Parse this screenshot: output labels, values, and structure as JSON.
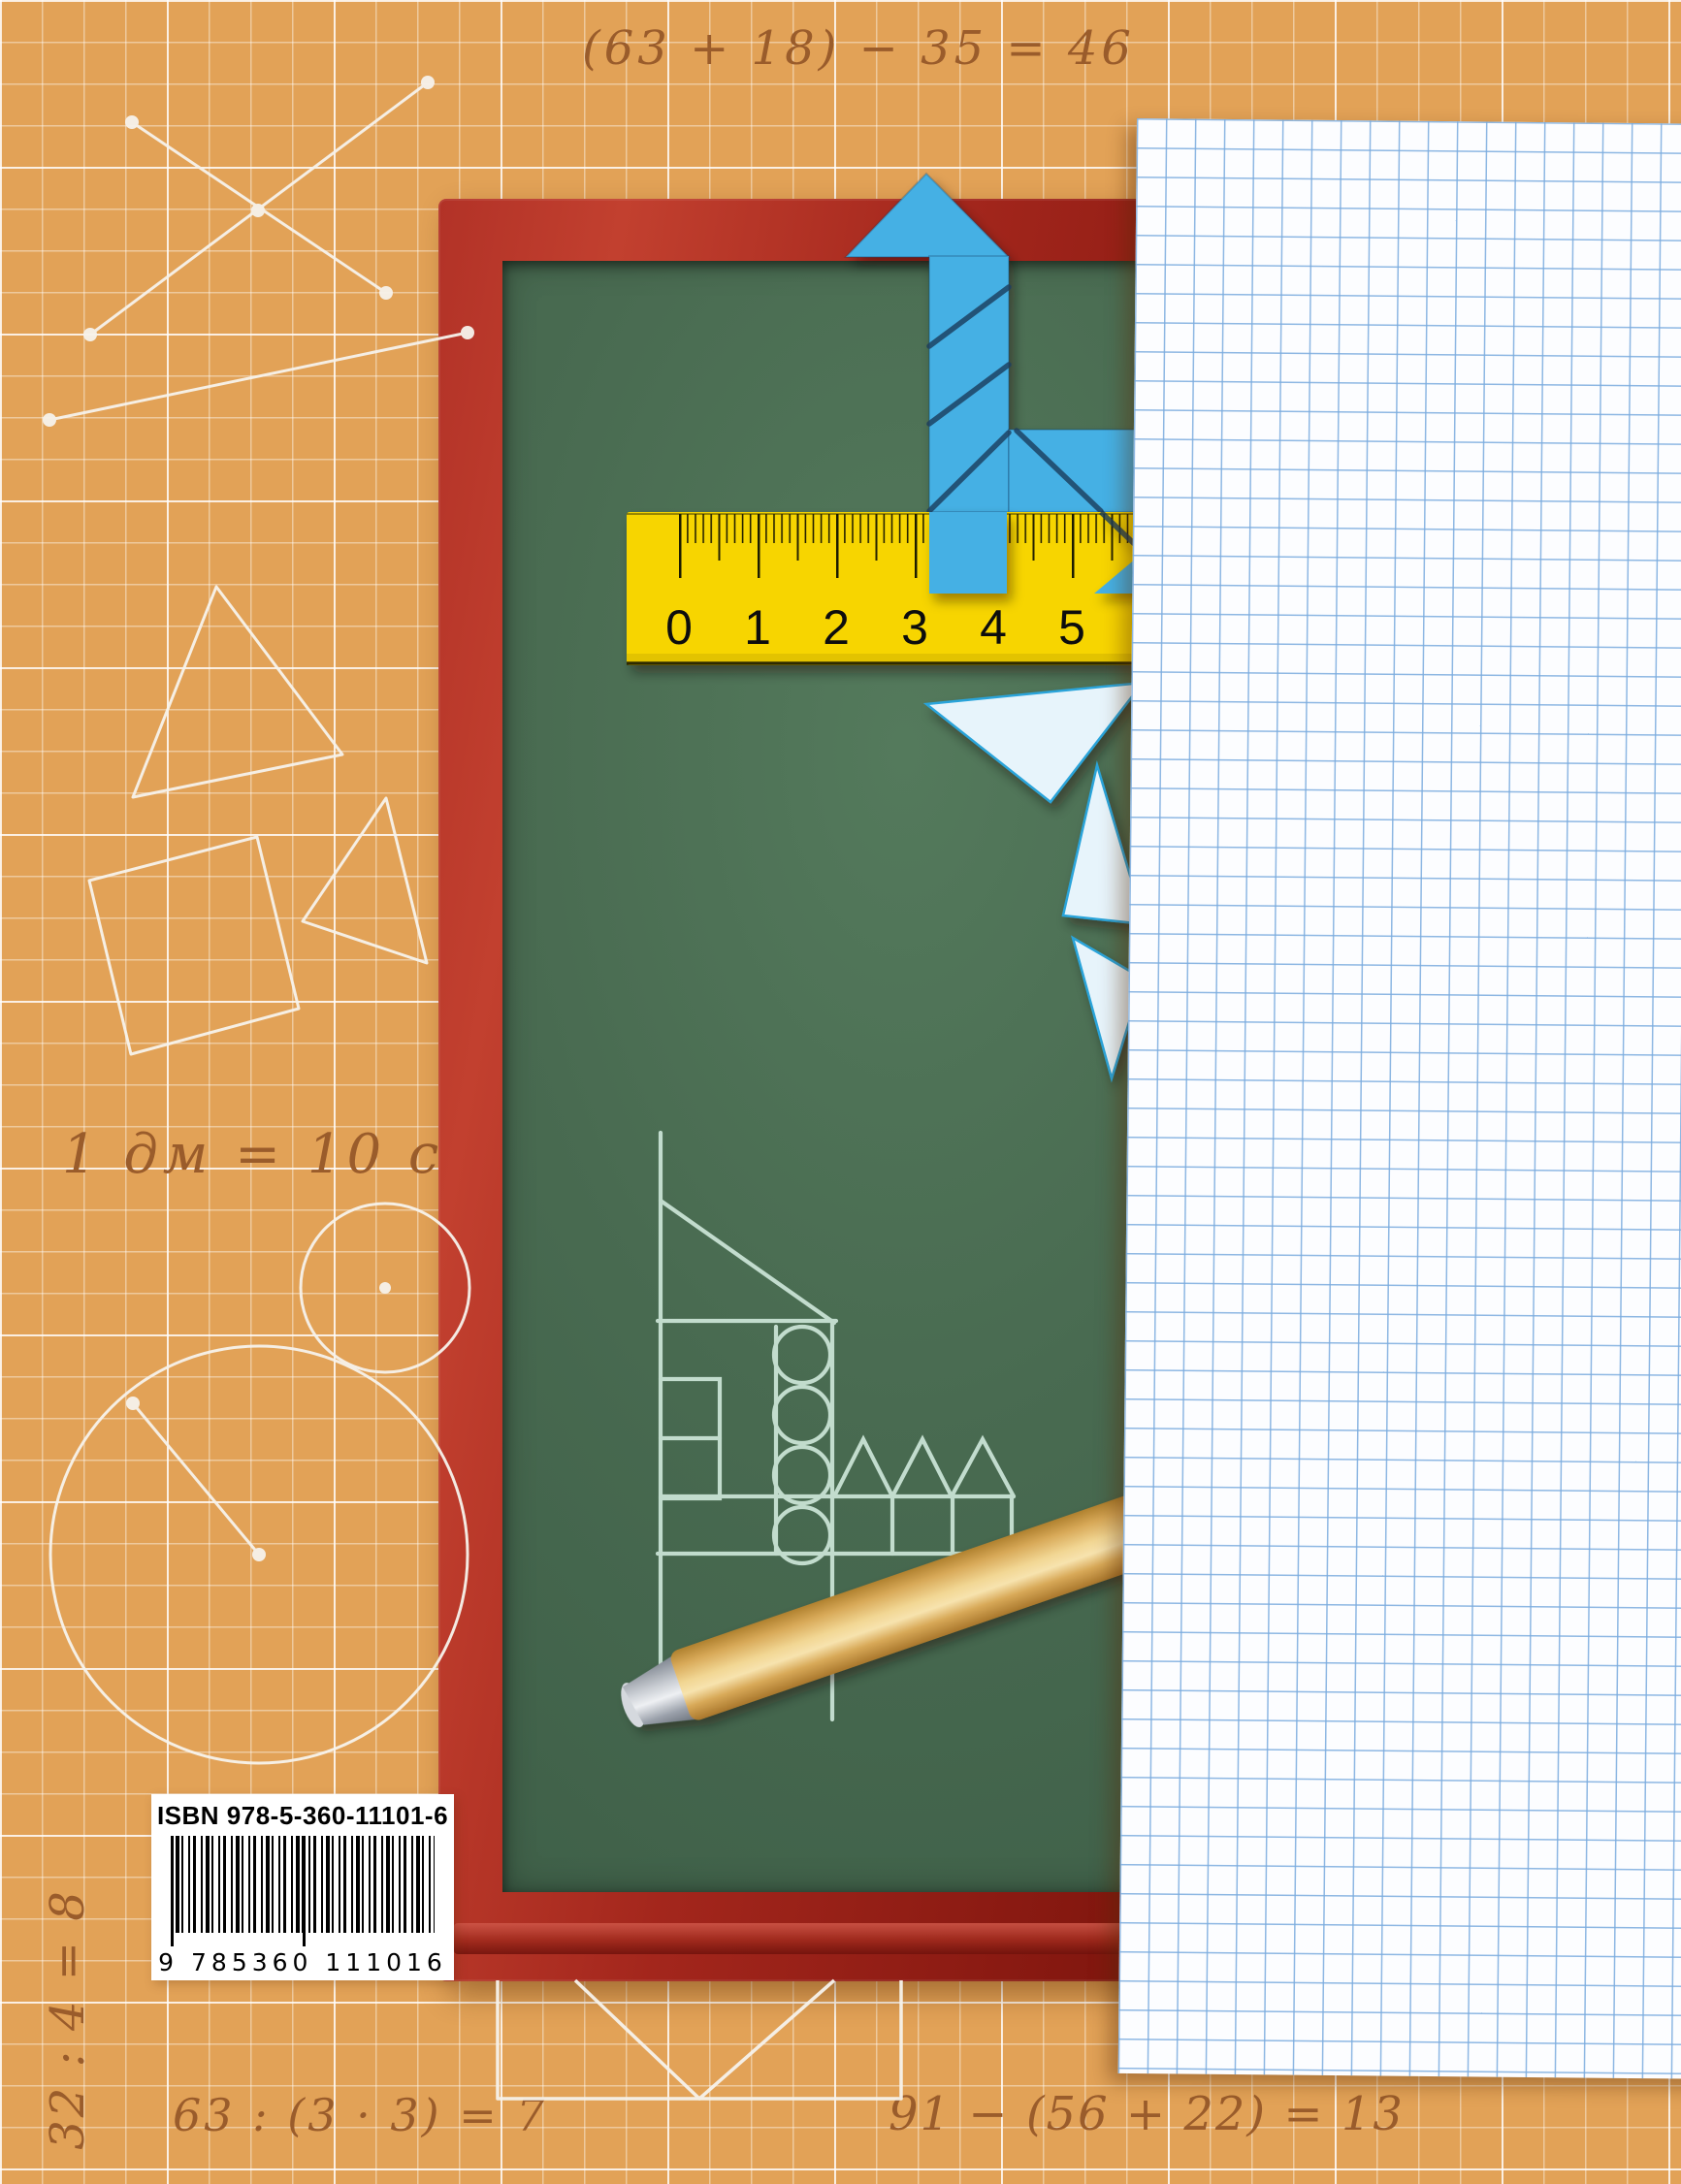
{
  "background": {
    "color": "#e2a257",
    "grid_color": "#ffffff"
  },
  "handwriting": {
    "ink_color": "#9a5c2b",
    "equation_top": "(63 + 18) − 35 = 46",
    "equation_dm": "1 дм = 10 см",
    "equation_vertical": "32 : 4 = 8",
    "equation_division": "63 : (3 · 3) = 7",
    "equation_bottom": "91 − (56 + 22) = 13"
  },
  "chalkboard": {
    "frame_color": "#a82c24",
    "surface_color": "#4b6e54"
  },
  "ruler": {
    "color": "#f7d506",
    "numbers": [
      "0",
      "1",
      "2",
      "3",
      "4",
      "5"
    ]
  },
  "tangram": {
    "blue": "#45b0e4",
    "pale": "#e7f4fb",
    "outline": "#2aa4da"
  },
  "chalk_drawing": {
    "color": "#cfe9dc"
  },
  "chalk_stick": {
    "body_color": "#e8bd6b",
    "tip_color": "#aab0b9"
  },
  "paper": {
    "color": "#fcfdff",
    "grid_color": "#8ab6e2"
  },
  "barcode": {
    "isbn_label": "ISBN 978-5-360-11101-6",
    "digits": "9 785360 111016"
  }
}
